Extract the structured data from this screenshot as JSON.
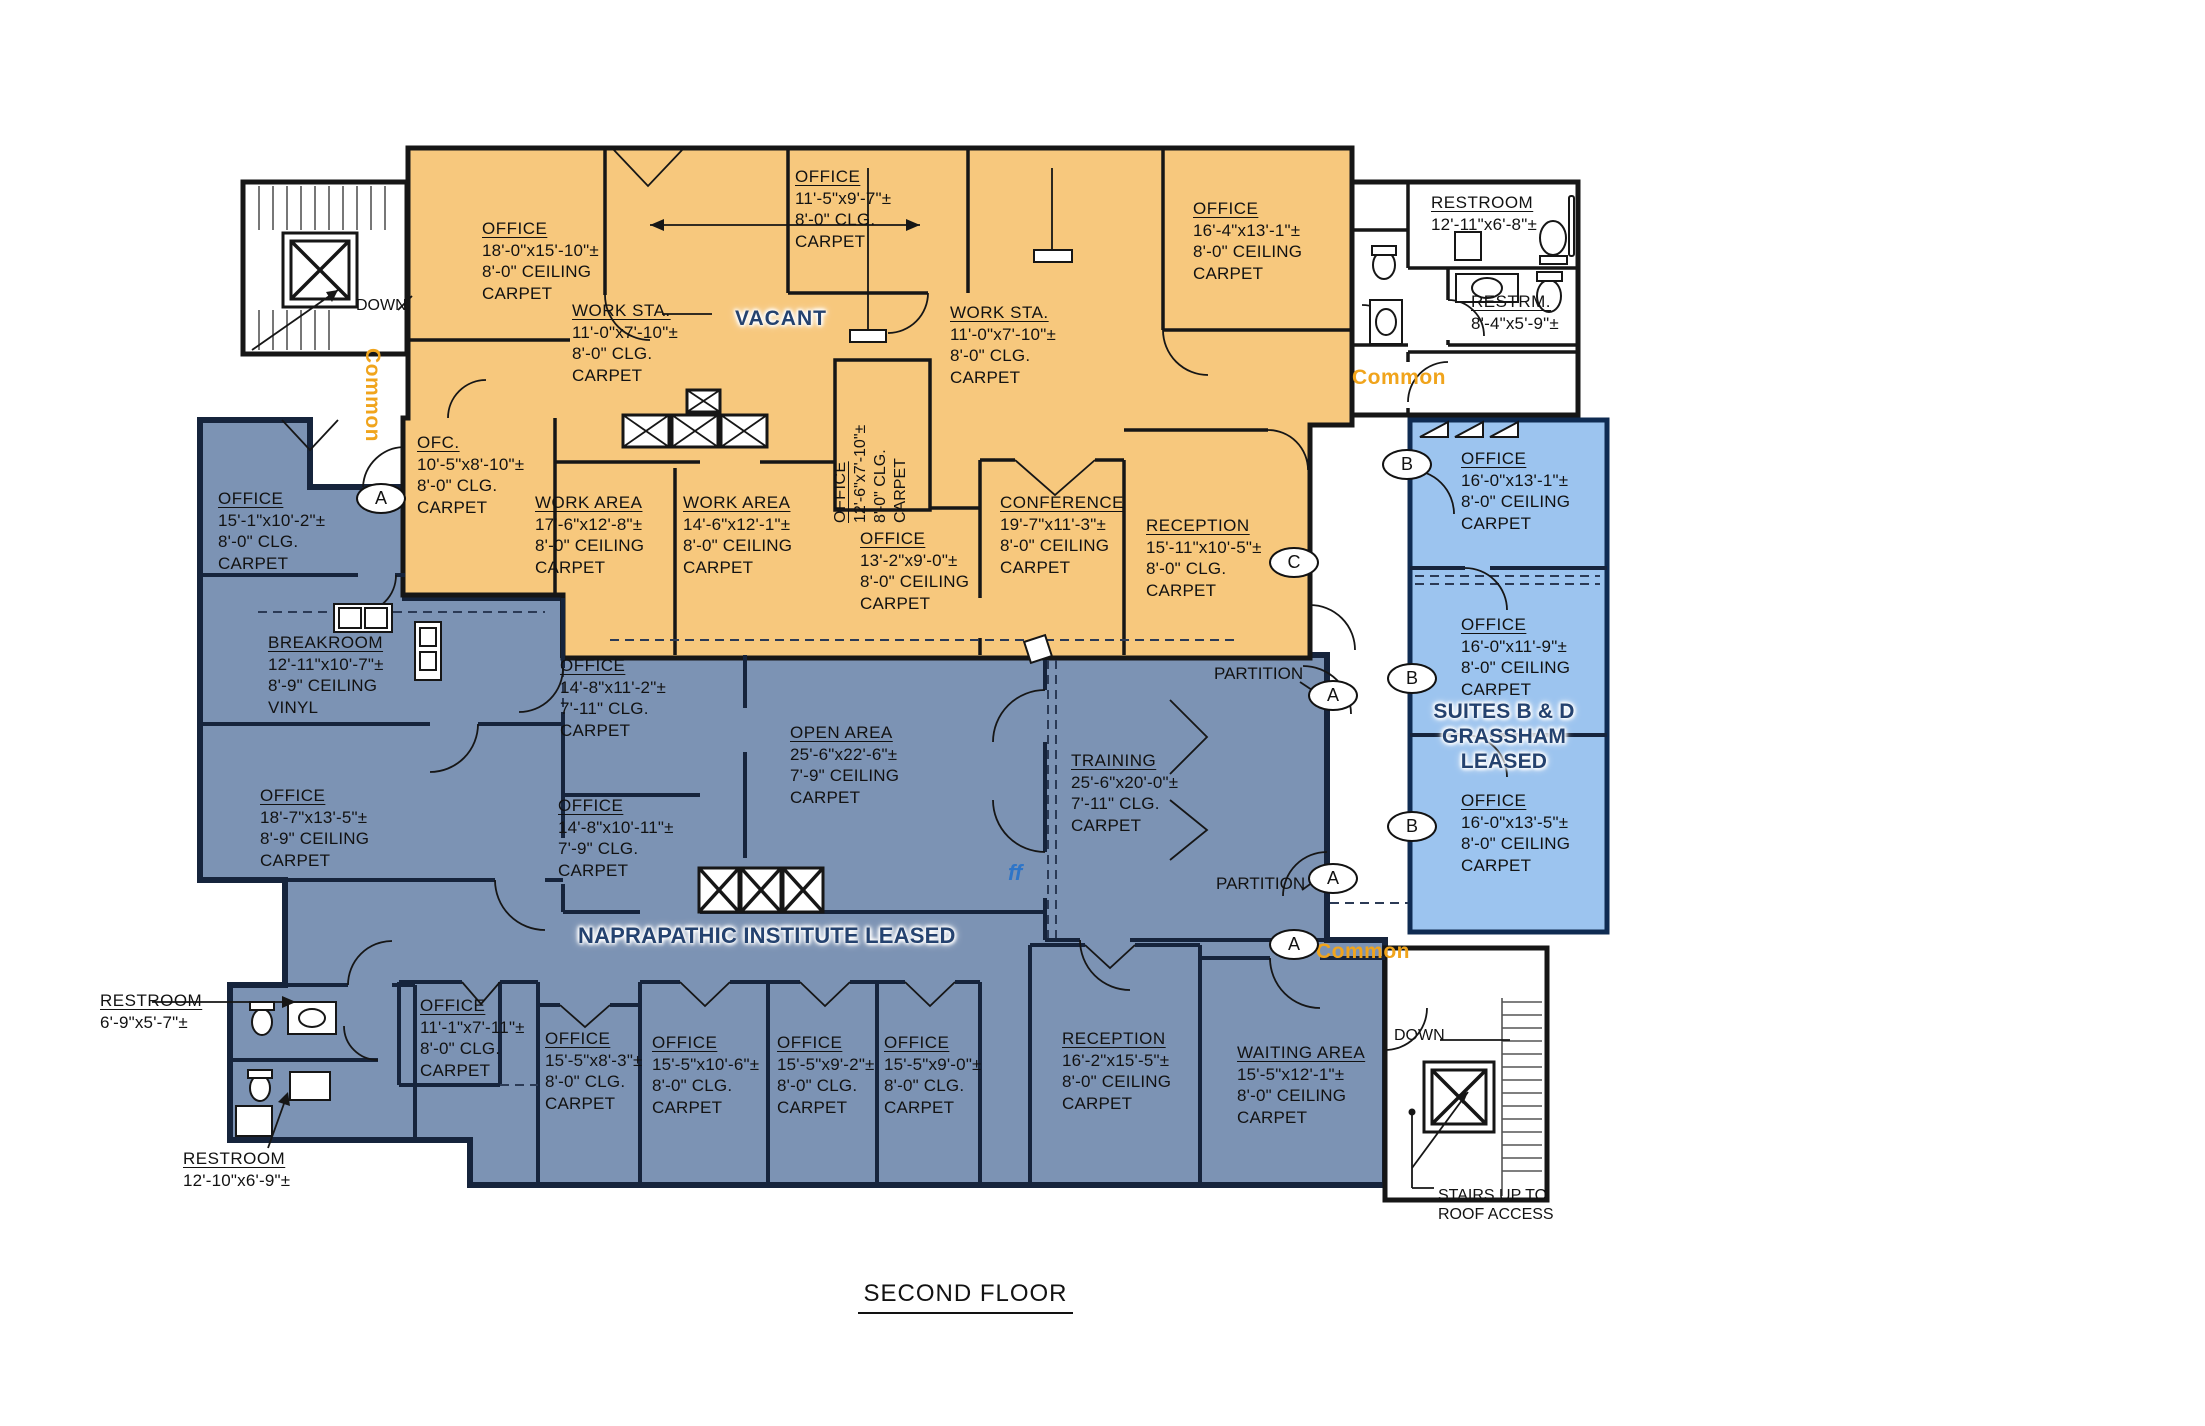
{
  "title": "SECOND FLOOR",
  "colors": {
    "orange": "#F7C87D",
    "slate": "#7C93B4",
    "lightblue": "#9CC4EF",
    "navy": "#24426F",
    "common": "#F0A41C",
    "ff": "#2E75C8"
  },
  "zone_labels": {
    "vacant": "VACANT",
    "naprapathic": "NAPRAPATHIC INSTITUTE LEASED",
    "suites_line1": "SUITES B & D",
    "suites_line2": "GRASSHAM",
    "suites_line3": "LEASED"
  },
  "annotations": {
    "down_tl": "DOWN",
    "down_br": "DOWN",
    "stairs_line1": "STAIRS UP TO",
    "stairs_line2": "ROOF ACCESS",
    "partition_top": "PARTITION",
    "partition_bottom": "PARTITION",
    "ff": "ff",
    "common_tl": "Common",
    "common_tr": "Common",
    "common_bottom": "Common"
  },
  "door_tags": [
    "A",
    "C",
    "A",
    "A",
    "A",
    "B",
    "B",
    "B"
  ],
  "rooms": [
    {
      "name": "OFFICE",
      "dims": "18'-0\"x15'-10\"±",
      "ceiling": "8'-0\" CEILING",
      "floor": "CARPET"
    },
    {
      "name": "WORK STA.",
      "dims": "11'-0\"x7'-10\"±",
      "ceiling": "8'-0\" CLG.",
      "floor": "CARPET"
    },
    {
      "name": "OFFICE",
      "dims": "11'-5\"x9'-7\"±",
      "ceiling": "8'-0\" CLG.",
      "floor": "CARPET"
    },
    {
      "name": "WORK STA.",
      "dims": "11'-0\"x7'-10\"±",
      "ceiling": "8'-0\" CLG.",
      "floor": "CARPET"
    },
    {
      "name": "OFFICE",
      "dims": "16'-4\"x13'-1\"±",
      "ceiling": "8'-0\" CEILING",
      "floor": "CARPET"
    },
    {
      "name": "OFC.",
      "dims": "10'-5\"x8'-10\"±",
      "ceiling": "8'-0\" CLG.",
      "floor": "CARPET"
    },
    {
      "name": "WORK AREA",
      "dims": "17'-6\"x12'-8\"±",
      "ceiling": "8'-0\" CEILING",
      "floor": "CARPET"
    },
    {
      "name": "WORK AREA",
      "dims": "14'-6\"x12'-1\"±",
      "ceiling": "8'-0\" CEILING",
      "floor": "CARPET"
    },
    {
      "name": "OFFICE",
      "dims": "12'-6\"x7'-10\"±",
      "ceiling": "8'-0\" CLG.",
      "floor": "CARPET"
    },
    {
      "name": "OFFICE",
      "dims": "13'-2\"x9'-0\"±",
      "ceiling": "8'-0\" CEILING",
      "floor": "CARPET"
    },
    {
      "name": "CONFERENCE",
      "dims": "19'-7\"x11'-3\"±",
      "ceiling": "8'-0\" CEILING",
      "floor": "CARPET"
    },
    {
      "name": "RECEPTION",
      "dims": "15'-11\"x10'-5\"±",
      "ceiling": "8'-0\" CLG.",
      "floor": "CARPET"
    },
    {
      "name": "OFFICE",
      "dims": "15'-1\"x10'-2\"±",
      "ceiling": "8'-0\" CLG.",
      "floor": "CARPET"
    },
    {
      "name": "BREAKROOM",
      "dims": "12'-11\"x10'-7\"±",
      "ceiling": "8'-9\" CEILING",
      "floor": "VINYL"
    },
    {
      "name": "OFFICE",
      "dims": "18'-7\"x13'-5\"±",
      "ceiling": "8'-9\" CEILING",
      "floor": "CARPET"
    },
    {
      "name": "OFFICE",
      "dims": "14'-8\"x11'-2\"±",
      "ceiling": "7'-11\" CLG.",
      "floor": "CARPET"
    },
    {
      "name": "OFFICE",
      "dims": "14'-8\"x10'-11\"±",
      "ceiling": "7'-9\" CLG.",
      "floor": "CARPET"
    },
    {
      "name": "OPEN AREA",
      "dims": "25'-6\"x22'-6\"±",
      "ceiling": "7'-9\" CEILING",
      "floor": "CARPET"
    },
    {
      "name": "TRAINING",
      "dims": "25'-6\"x20'-0\"±",
      "ceiling": "7'-11\" CLG.",
      "floor": "CARPET"
    },
    {
      "name": "OFFICE",
      "dims": "11'-1\"x7'-11\"±",
      "ceiling": "8'-0\" CLG.",
      "floor": "CARPET"
    },
    {
      "name": "OFFICE",
      "dims": "15'-5\"x8'-3\"±",
      "ceiling": "8'-0\" CLG.",
      "floor": "CARPET"
    },
    {
      "name": "OFFICE",
      "dims": "15'-5\"x10'-6\"±",
      "ceiling": "8'-0\" CLG.",
      "floor": "CARPET"
    },
    {
      "name": "OFFICE",
      "dims": "15'-5\"x9'-2\"±",
      "ceiling": "8'-0\" CLG.",
      "floor": "CARPET"
    },
    {
      "name": "OFFICE",
      "dims": "15'-5\"x9'-0\"±",
      "ceiling": "8'-0\" CLG.",
      "floor": "CARPET"
    },
    {
      "name": "RECEPTION",
      "dims": "16'-2\"x15'-5\"±",
      "ceiling": "8'-0\" CEILING",
      "floor": "CARPET"
    },
    {
      "name": "WAITING AREA",
      "dims": "15'-5\"x12'-1\"±",
      "ceiling": "8'-0\" CEILING",
      "floor": "CARPET"
    },
    {
      "name": "OFFICE",
      "dims": "16'-0\"x13'-1\"±",
      "ceiling": "8'-0\" CEILING",
      "floor": "CARPET"
    },
    {
      "name": "OFFICE",
      "dims": "16'-0\"x11'-9\"±",
      "ceiling": "8'-0\" CEILING",
      "floor": "CARPET"
    },
    {
      "name": "OFFICE",
      "dims": "16'-0\"x13'-5\"±",
      "ceiling": "8'-0\" CEILING",
      "floor": "CARPET"
    },
    {
      "name": "RESTROOM",
      "dims": "12'-11\"x6'-8\"±"
    },
    {
      "name": "RESTRM.",
      "dims": "8'-4\"x5'-9\"±"
    },
    {
      "name": "RESTROOM",
      "dims": "6'-9\"x5'-7\"±"
    },
    {
      "name": "RESTROOM",
      "dims": "12'-10\"x6'-9\"±"
    }
  ]
}
